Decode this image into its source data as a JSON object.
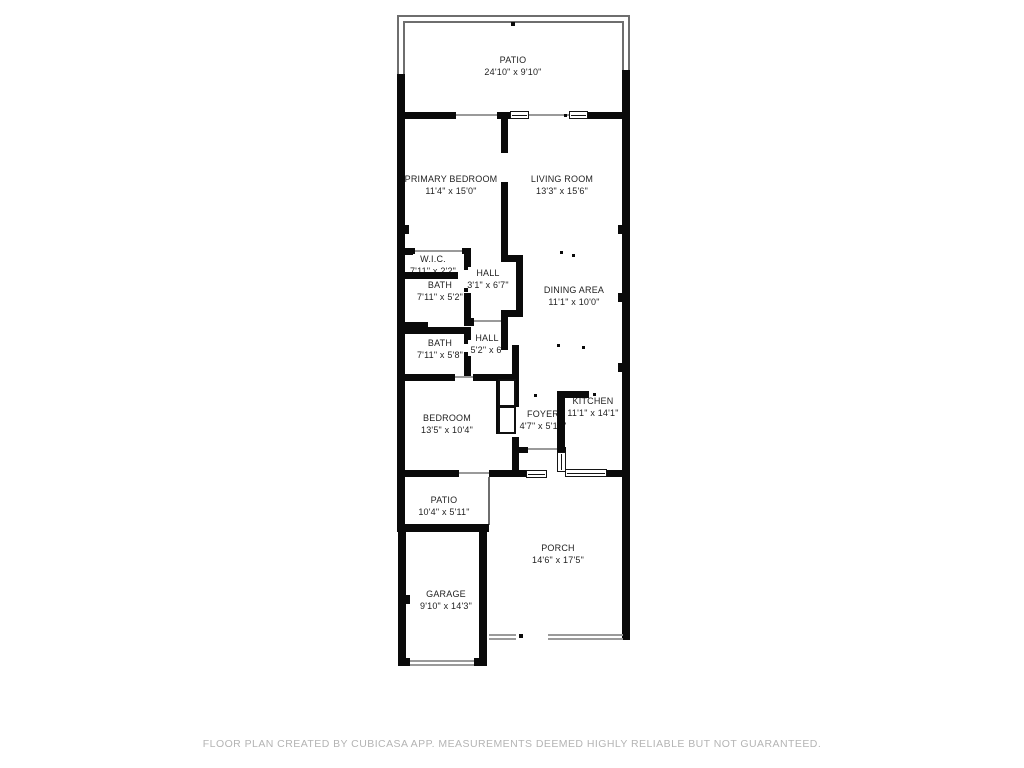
{
  "page": {
    "background": "#ffffff"
  },
  "floor_plan": {
    "creator_note": "CubiCasa floor plan",
    "colors": {
      "wall": "#0a0a0a",
      "railing": "#6e6e6e",
      "room_text": "#1f1f1f",
      "footer_text": "#b4b4b4"
    },
    "rooms": [
      {
        "id": "patio-top",
        "name": "PATIO",
        "dims": "24'10\" x 9'10\""
      },
      {
        "id": "primary-bedroom",
        "name": "PRIMARY BEDROOM",
        "dims": "11'4\" x 15'0\""
      },
      {
        "id": "living-room",
        "name": "LIVING ROOM",
        "dims": "13'3\" x 15'6\""
      },
      {
        "id": "wic",
        "name": "W.I.C.",
        "dims": "7'11\" x 2'2\""
      },
      {
        "id": "hall-upper",
        "name": "HALL",
        "dims": "3'1\" x 6'7\""
      },
      {
        "id": "bath-upper",
        "name": "BATH",
        "dims": "7'11\" x 5'2\""
      },
      {
        "id": "dining-area",
        "name": "DINING AREA",
        "dims": "11'1\" x 10'0\""
      },
      {
        "id": "bath-lower",
        "name": "BATH",
        "dims": "7'11\" x 5'8\""
      },
      {
        "id": "hall-lower",
        "name": "HALL",
        "dims": "5'2\" x 6'"
      },
      {
        "id": "bedroom",
        "name": "BEDROOM",
        "dims": "13'5\" x 10'4\""
      },
      {
        "id": "foyer",
        "name": "FOYER",
        "dims": "4'7\" x 5'10\""
      },
      {
        "id": "kitchen",
        "name": "KITCHEN",
        "dims": "11'1\" x 14'1\""
      },
      {
        "id": "patio-side",
        "name": "PATIO",
        "dims": "10'4\" x 5'11\""
      },
      {
        "id": "porch",
        "name": "PORCH",
        "dims": "14'6\" x 17'5\""
      },
      {
        "id": "garage",
        "name": "GARAGE",
        "dims": "9'10\" x 14'3\""
      }
    ]
  },
  "footer": {
    "disclaimer": "FLOOR PLAN CREATED BY CUBICASA APP. MEASUREMENTS DEEMED HIGHLY RELIABLE BUT NOT GUARANTEED."
  }
}
